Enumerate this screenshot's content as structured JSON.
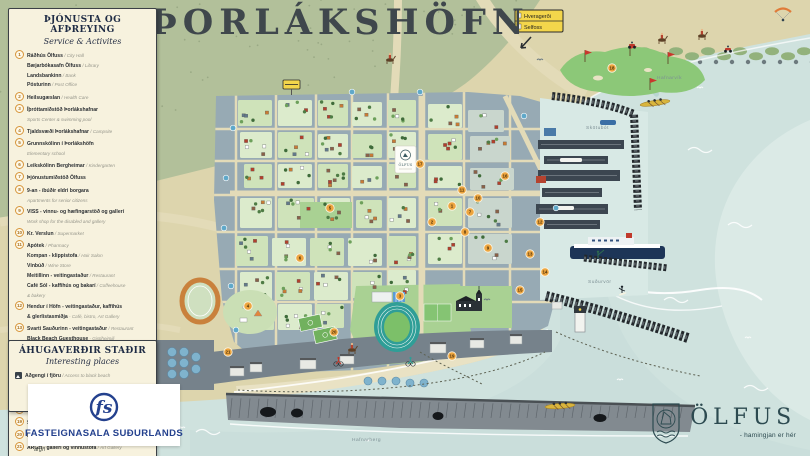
{
  "title": "ÞORLÁKSHÖFN",
  "legend": {
    "header": "ÞJÓNUSTA OG AFÞREYING",
    "subheader": "Service & Activites",
    "items": [
      {
        "n": "1",
        "lines": [
          [
            {
              "t": "Ráðhús Ölfuss",
              "s": "b"
            },
            {
              "t": " / City Hall",
              "s": "l"
            }
          ],
          [
            {
              "t": "Bæjarbókasafn Ölfuss",
              "s": "b"
            },
            {
              "t": " / Library",
              "s": "l"
            }
          ],
          [
            {
              "t": "Landsbankinn",
              "s": "b"
            },
            {
              "t": " / Bank",
              "s": "l"
            }
          ],
          [
            {
              "t": "Pósturinn",
              "s": "b"
            },
            {
              "t": " / Post Office",
              "s": "l"
            }
          ]
        ]
      },
      {
        "n": "2",
        "lines": [
          [
            {
              "t": "Heilsugæslan",
              "s": "b"
            },
            {
              "t": " / Health Care",
              "s": "l"
            }
          ]
        ]
      },
      {
        "n": "3",
        "lines": [
          [
            {
              "t": "Íþróttamiðstöð Þorlákshafnar",
              "s": "b"
            }
          ],
          [
            {
              "t": "Sports Center & swimming pool",
              "s": "l"
            }
          ]
        ]
      },
      {
        "n": "4",
        "lines": [
          [
            {
              "t": "Tjaldsvæði Þorlákshafnar",
              "s": "b"
            },
            {
              "t": " / Campsite",
              "s": "l"
            }
          ]
        ]
      },
      {
        "n": "5",
        "lines": [
          [
            {
              "t": "Grunnskólinn í Þorlákshöfn",
              "s": "b"
            }
          ],
          [
            {
              "t": "Elementary school",
              "s": "l"
            }
          ]
        ]
      },
      {
        "n": "6",
        "lines": [
          [
            {
              "t": "Leikskólinn Bergheimar",
              "s": "b"
            },
            {
              "t": " / Kindergarten",
              "s": "l"
            }
          ]
        ]
      },
      {
        "n": "7",
        "lines": [
          [
            {
              "t": "Þjónustumiðstöð Ölfuss",
              "s": "b"
            }
          ]
        ]
      },
      {
        "n": "8",
        "lines": [
          [
            {
              "t": "9-an - íbúðir eldri borgara",
              "s": "b"
            }
          ],
          [
            {
              "t": "Apartments for senior citizens",
              "s": "l"
            }
          ]
        ]
      },
      {
        "n": "9",
        "lines": [
          [
            {
              "t": "VISS - vinnu- og hæfingarstöð og gallerí",
              "s": "b"
            }
          ],
          [
            {
              "t": "Work shop for the disabled and gallery",
              "s": "l"
            }
          ]
        ]
      },
      {
        "n": "10",
        "lines": [
          [
            {
              "t": "Kr. Verslun",
              "s": "b"
            },
            {
              "t": " / Supermarket",
              "s": "l"
            }
          ]
        ]
      },
      {
        "n": "11",
        "lines": [
          [
            {
              "t": "Apótek",
              "s": "b"
            },
            {
              "t": " / Pharmacy",
              "s": "l"
            }
          ],
          [
            {
              "t": "Kompan - klippistofa",
              "s": "b"
            },
            {
              "t": " / Hair Salon",
              "s": "l"
            }
          ],
          [
            {
              "t": "Vínbúð",
              "s": "b"
            },
            {
              "t": " / Wine Store",
              "s": "l"
            }
          ],
          [
            {
              "t": "Meitillinn - veitingastaður",
              "s": "b"
            },
            {
              "t": " / Restaurant",
              "s": "l"
            }
          ],
          [
            {
              "t": "Café Sól - kaffihús og bakarí",
              "s": "b"
            },
            {
              "t": " / Coffeehouse",
              "s": "l"
            }
          ],
          [
            {
              "t": "& bakery",
              "s": "l"
            }
          ]
        ]
      },
      {
        "n": "12",
        "lines": [
          [
            {
              "t": "Hendur í Höfn - veitingastaður, kaffihús",
              "s": "b"
            }
          ],
          [
            {
              "t": "& glerlistasmiðja",
              "s": "b"
            },
            {
              "t": " - Café, bistro, Art Gallery",
              "s": "l"
            }
          ]
        ]
      },
      {
        "n": "13",
        "lines": [
          [
            {
              "t": "Svarti Sauðurinn - veitingastaður",
              "s": "b"
            },
            {
              "t": " / Restaurant",
              "s": "l"
            }
          ],
          [
            {
              "t": "Black Beach Guesthouse",
              "s": "b"
            },
            {
              "t": " - Gistiheimili",
              "s": "l"
            }
          ]
        ]
      },
      {
        "n": "14",
        "lines": [
          [
            {
              "t": "Black Beach Tours - afþreying",
              "s": "b"
            },
            {
              "t": " / Activities",
              "s": "l"
            }
          ]
        ]
      },
      {
        "n": "15",
        "lines": [
          [
            {
              "t": "Black Beach Cottages - orlofshús",
              "s": "b"
            },
            {
              "t": " / Cottages",
              "s": "l"
            }
          ]
        ]
      },
      {
        "n": "16",
        "lines": [
          [
            {
              "t": "Skálinn - bensínstöð, hraðbanki og sjoppa",
              "s": "b"
            }
          ],
          [
            {
              "t": "Gas station, ATM & shop",
              "s": "l"
            }
          ]
        ]
      },
      {
        "n": "17",
        "lines": [
          [
            {
              "t": "ÓB bensínstöð",
              "s": "b"
            },
            {
              "t": " / Gas station",
              "s": "l"
            }
          ]
        ]
      },
      {
        "n": "18",
        "lines": [
          [
            {
              "t": "Golfvöllur",
              "s": "b"
            },
            {
              "t": " / Golf course",
              "s": "l"
            }
          ]
        ]
      },
      {
        "n": "19",
        "lines": [
          [
            {
              "t": "Strandblakvöllur",
              "s": "b"
            },
            {
              "t": " / Beach volleyball court",
              "s": "l"
            }
          ]
        ]
      },
      {
        "n": "20",
        "lines": [
          [
            {
              "t": "Frisbígolfvöllur",
              "s": "b"
            },
            {
              "t": " / Frisbee golf course",
              "s": "l"
            }
          ]
        ]
      },
      {
        "n": "21",
        "lines": [
          [
            {
              "t": "ARGH - gallerí og vinnustofa",
              "s": "b"
            },
            {
              "t": " / Art Gallery",
              "s": "l"
            }
          ]
        ]
      }
    ]
  },
  "places": {
    "header": "ÁHUGAVERÐIR STAÐIR",
    "subheader": "Interesting places",
    "items": [
      {
        "icon": "beach-access-icon",
        "lines": [
          [
            {
              "t": "Aðgengi í fjöru",
              "s": "b"
            },
            {
              "t": " / Access to black beach",
              "s": "l"
            }
          ]
        ]
      }
    ]
  },
  "logos": {
    "fasteignasala": "FASTEIGNASALA SUÐURLANDS",
    "fs_monogram": "fs",
    "olfus": "ÖLFUS",
    "olfus_tagline": "- hamingjan er hér"
  },
  "road_sign": {
    "rows": [
      "Hveragerði",
      "Selfoss"
    ]
  },
  "map_plaque": "ÖLFUS",
  "credit": "argh",
  "map": {
    "water_labels": [
      {
        "t": "Skötubót",
        "x": 586,
        "y": 129
      },
      {
        "t": "Suðurvör",
        "x": 588,
        "y": 283
      },
      {
        "t": "Hafnarvík",
        "x": 657,
        "y": 79
      },
      {
        "t": "Hafnarberg",
        "x": 352,
        "y": 441
      }
    ],
    "markers": [
      {
        "n": 1,
        "x": 452,
        "y": 206
      },
      {
        "n": 2,
        "x": 432,
        "y": 222
      },
      {
        "n": 3,
        "x": 400,
        "y": 296
      },
      {
        "n": 4,
        "x": 248,
        "y": 306
      },
      {
        "n": 5,
        "x": 330,
        "y": 208
      },
      {
        "n": 6,
        "x": 300,
        "y": 258
      },
      {
        "n": 7,
        "x": 470,
        "y": 212
      },
      {
        "n": 8,
        "x": 465,
        "y": 232
      },
      {
        "n": 9,
        "x": 488,
        "y": 248
      },
      {
        "n": 10,
        "x": 478,
        "y": 198
      },
      {
        "n": 11,
        "x": 462,
        "y": 190
      },
      {
        "n": 12,
        "x": 540,
        "y": 222
      },
      {
        "n": 13,
        "x": 530,
        "y": 254
      },
      {
        "n": 14,
        "x": 545,
        "y": 272
      },
      {
        "n": 15,
        "x": 520,
        "y": 290
      },
      {
        "n": 16,
        "x": 505,
        "y": 176
      },
      {
        "n": 17,
        "x": 420,
        "y": 164
      },
      {
        "n": 18,
        "x": 612,
        "y": 68
      },
      {
        "n": 19,
        "x": 452,
        "y": 356
      },
      {
        "n": 20,
        "x": 334,
        "y": 332
      },
      {
        "n": 21,
        "x": 228,
        "y": 352
      }
    ],
    "colors": {
      "sea": "#cfe2de",
      "sea_light": "#dbeae6",
      "sea_stripe": "#b9d6d2",
      "sand": "#ddd5ad",
      "beach": "#e9e2c4",
      "olive": "#b2c09a",
      "urban": "#97aab4",
      "block_green": "#cfe3ba",
      "block_green2": "#dcebcc",
      "block_gray": "#c9d6cd",
      "park": "#a9d193",
      "road": "#e3dbb8",
      "pier": "#3c4650",
      "industry": "#76828b",
      "cliff": "#828a90",
      "rock": "#23282c",
      "marker": "#eda53f",
      "info": "#5fa8c9",
      "track": "#2f9e97",
      "ring": "#c9813c",
      "sign_yellow": "#f3d64b",
      "navy": "#24418e",
      "olfus_teal": "#2c4a50",
      "flag_red": "#c8372d"
    },
    "icons": [
      "golf-flag-icon",
      "church-icon",
      "lighthouse-icon",
      "ferry-icon",
      "rowing-boat-icon",
      "surfer-icon",
      "horse-rider-icon",
      "atv-icon",
      "cyclist-icon",
      "paraglider-icon",
      "seagull-icon",
      "info-marker",
      "number-marker",
      "road-sign",
      "campsite-icon"
    ]
  }
}
